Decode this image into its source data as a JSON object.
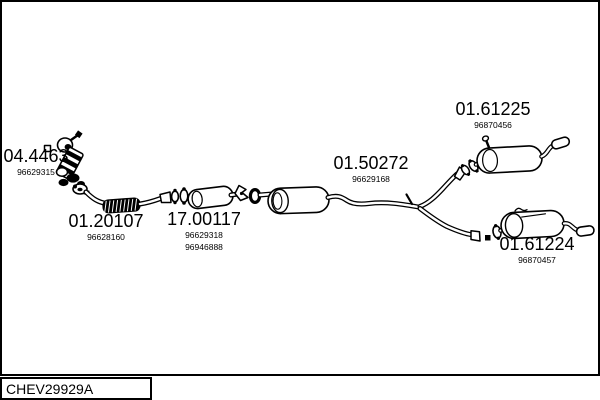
{
  "window": {
    "width": 600,
    "height": 400,
    "background": "#ffffff"
  },
  "title_block": {
    "code": "CHEV29929A"
  },
  "diagram": {
    "kind": "exhaust-system-parts-diagram",
    "line_color": "#000000",
    "labels": [
      {
        "code": "04.4463",
        "part_numbers": [
          "96629315"
        ]
      },
      {
        "code": "01.20107",
        "part_numbers": [
          "96628160"
        ]
      },
      {
        "code": "17.00117",
        "part_numbers": [
          "96629318",
          "96946888"
        ]
      },
      {
        "code": "01.50272",
        "part_numbers": [
          "96629168"
        ]
      },
      {
        "code": "01.61225",
        "part_numbers": [
          "96870456"
        ]
      },
      {
        "code": "01.61224",
        "part_numbers": [
          "96870457"
        ]
      }
    ]
  }
}
